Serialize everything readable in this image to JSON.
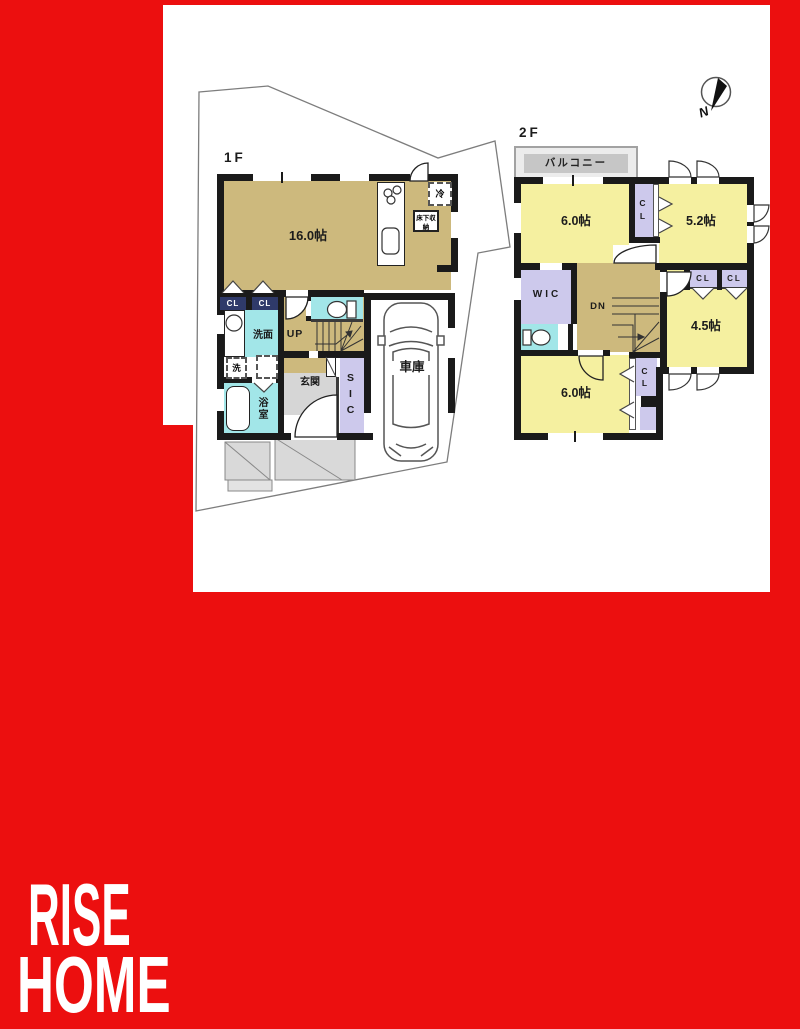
{
  "colors": {
    "frame_red": "#ec0f0f",
    "wall": "#1a1a1a",
    "tan": "#cdb97d",
    "yellow": "#f5f0a0",
    "lavender": "#cdc9ec",
    "teal": "#a2e6e8",
    "gray_entrance": "#d6d6d6",
    "gray_balcony": "#c6c6c6",
    "navy_closet": "#2f3a6a",
    "lot_line": "#7d7d7d"
  },
  "branding": {
    "line1": "RISE",
    "line2": "HOME"
  },
  "compass": {
    "north_label": "N"
  },
  "floor1": {
    "label": "1F",
    "ldk": "16.0帖",
    "refrigerator": "冷",
    "floor_storage": "床下収納",
    "closet_a": "CL",
    "closet_b": "CL",
    "washroom": "洗面",
    "washer": "洗",
    "bath": "浴室",
    "entrance": "玄関",
    "stairs": "UP",
    "shoe_closet": "SIC",
    "garage": "車庫"
  },
  "floor2": {
    "label": "2F",
    "balcony": "バルコニー",
    "bedroom_nw": "6.0帖",
    "closet_n": "CL",
    "bedroom_ne": "5.2帖",
    "wic": "WIC",
    "stairs": "DN",
    "closet_a": "CL",
    "closet_b": "CL",
    "bedroom_se": "4.5帖",
    "bedroom_sw": "6.0帖",
    "closet_sw": "CL"
  }
}
